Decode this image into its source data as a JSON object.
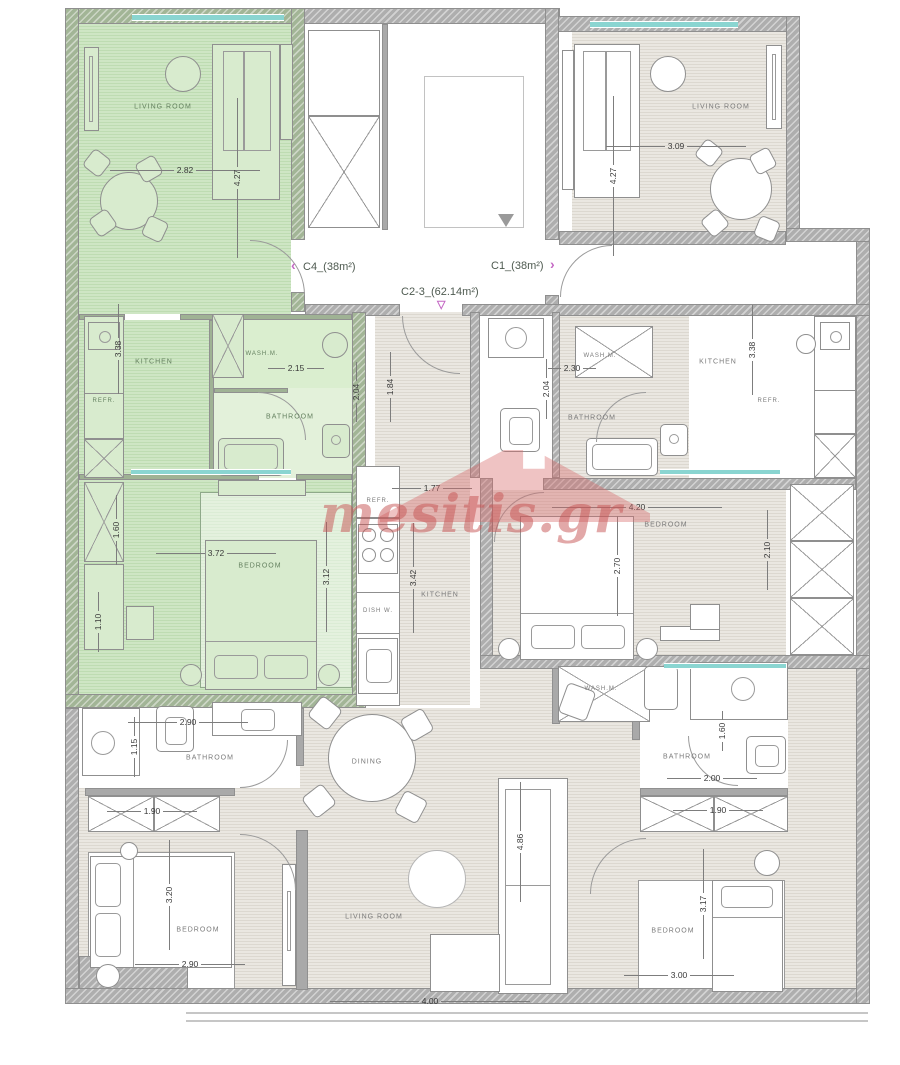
{
  "plan": {
    "watermark": "mesitis.gr",
    "units": {
      "c4": {
        "label": "C4_(38m²)",
        "arrow": "‹"
      },
      "c1": {
        "label": "C1_(38m²)",
        "arrow": "›"
      },
      "c23": {
        "label": "C2-3_(62.14m²)",
        "arrow": "▽"
      }
    }
  },
  "rooms": {
    "c4_living": "LIVING ROOM",
    "c4_kitchen": "KITCHEN",
    "c4_refr": "REFR.",
    "c4_washm": "WASH.M.",
    "c4_bath": "BATHROOM",
    "c4_bed": "BEDROOM",
    "c1_living": "LIVING ROOM",
    "c1_kitchen": "KITCHEN",
    "c1_refr": "REFR.",
    "c1_washm": "WASH.M.",
    "c1_bath": "BATHROOM",
    "c1_bed": "BEDROOM",
    "c23_kitchen": "KITCHEN",
    "c23_refr": "REFR.",
    "c23_dishw": "DISH W.",
    "c23_washm": "WASH.M.",
    "c23_bath_left": "BATHROOM",
    "c23_bath_right": "BATHROOM",
    "c23_dining": "DINING",
    "c23_living": "LIVING ROOM",
    "c23_bed_left": "BEDROOM",
    "c23_bed_right": "BEDROOM"
  },
  "dims": {
    "c4_living_w": "2.82",
    "c4_living_h": "4.27",
    "c4_kitchen_h": "3.38",
    "c4_washm_w": "2.15",
    "c4_bath_h": "2.04",
    "c4_bed_w": "3.72",
    "c4_bed_h": "3.12",
    "c4_closet_a": "1.60",
    "c4_closet_b": "1.10",
    "c1_living_w": "3.09",
    "c1_living_h": "4.27",
    "c1_washm_w": "2.30",
    "c1_kitchen_h": "3.38",
    "c1_bed_w": "4.20",
    "c1_bed_h": "2.70",
    "c1_closet": "2.10",
    "c23_entry_h": "1.84",
    "c23_hall_w": "1.77",
    "c23_kitchen_h": "3.42",
    "c23_bath_mid_h": "2.04",
    "c23_bathl_w": "2.90",
    "c23_bathl_shower_h": "1.15",
    "c23_closetl_w": "1.90",
    "c23_bedl_h": "3.20",
    "c23_bedl_w": "2.90",
    "c23_sofa_h": "4.86",
    "c23_living_w": "4.00",
    "c23_bathr_w": "2.00",
    "c23_bathr_shower_h": "1.60",
    "c23_closetr_w": "1.90",
    "c23_bedr_h": "3.17",
    "c23_bedr_w": "3.00"
  }
}
